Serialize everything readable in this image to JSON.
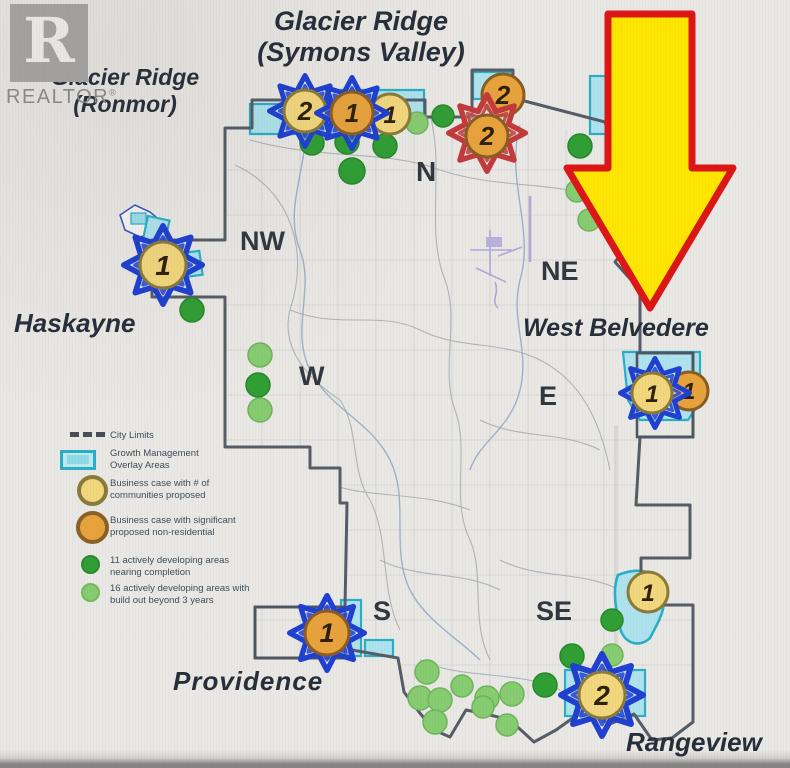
{
  "brand": {
    "name": "REALTOR",
    "reg": "®",
    "logo_letter": "R"
  },
  "map": {
    "communities": {
      "glacier_symons": {
        "line1": "Glacier Ridge",
        "line2": "(Symons Valley)"
      },
      "glacier_ronmor": {
        "line1": "Glacier Ridge",
        "line2": "(Ronmor)"
      },
      "haskayne": {
        "label": "Haskayne"
      },
      "west_belvedere": {
        "label": "West Belvedere"
      },
      "providence": {
        "label": "Providence"
      },
      "rangeview": {
        "label": "Rangeview"
      }
    },
    "quadrants": {
      "n": "N",
      "nw": "NW",
      "ne": "NE",
      "w": "W",
      "e": "E",
      "s": "S",
      "se": "SE"
    },
    "markers": {
      "glacier_1": {
        "number": "2",
        "circle": "yellow",
        "star": "blue"
      },
      "glacier_2": {
        "number": "1",
        "circle": "orange",
        "star": "blue"
      },
      "glacier_3": {
        "number": "1",
        "circle": "yellow",
        "star": "none"
      },
      "north_east_upper": {
        "number": "2",
        "circle": "orange",
        "star": "none"
      },
      "north_east_star": {
        "number": "2",
        "circle": "orange",
        "star": "red"
      },
      "haskayne": {
        "number": "1",
        "circle": "yellow",
        "star": "blue"
      },
      "west_belvedere_1": {
        "number": "1",
        "circle": "yellow",
        "star": "blue"
      },
      "west_belvedere_2": {
        "number": "1",
        "circle": "orange",
        "star": "none"
      },
      "providence": {
        "number": "1",
        "circle": "orange",
        "star": "blue"
      },
      "south_east": {
        "number": "2",
        "circle": "yellow",
        "star": "blue"
      },
      "east_edge": {
        "number": "1",
        "circle": "yellow",
        "star": "none"
      }
    },
    "legend": {
      "items": [
        {
          "id": "city_limits",
          "line1": "City Limits",
          "line2": "",
          "swatch": "dashed-line"
        },
        {
          "id": "growth_overlay",
          "line1": "Growth Management",
          "line2": "Overlay Areas",
          "swatch": "cyan-rect"
        },
        {
          "id": "business_case_communities",
          "line1": "Business case with # of",
          "line2": "communities proposed",
          "swatch": "yellow-circle"
        },
        {
          "id": "business_case_nonresidential",
          "line1": "Business case with significant",
          "line2": "proposed non-residential",
          "swatch": "orange-circle"
        },
        {
          "id": "active_nearing",
          "line1": "11 actively developing areas",
          "line2": "nearing completion",
          "swatch": "dark-green-dot"
        },
        {
          "id": "active_beyond",
          "line1": "16 actively developing areas with",
          "line2": "build out beyond 3 years",
          "swatch": "light-green-dot"
        }
      ]
    },
    "colors": {
      "arrow_fill": "#ffe600",
      "arrow_border": "#dd1515",
      "star_blue": "#1e3fd0",
      "star_red": "#c23a3a",
      "circle_yellow": "#f2d77c",
      "circle_orange": "#e8a23c",
      "dot_dark_green": "#2f9e33",
      "dot_light_green": "#86cc70",
      "overlay_cyan": "#aee3ed",
      "overlay_border": "#2aaec6",
      "city_boundary": "#555c66"
    }
  }
}
